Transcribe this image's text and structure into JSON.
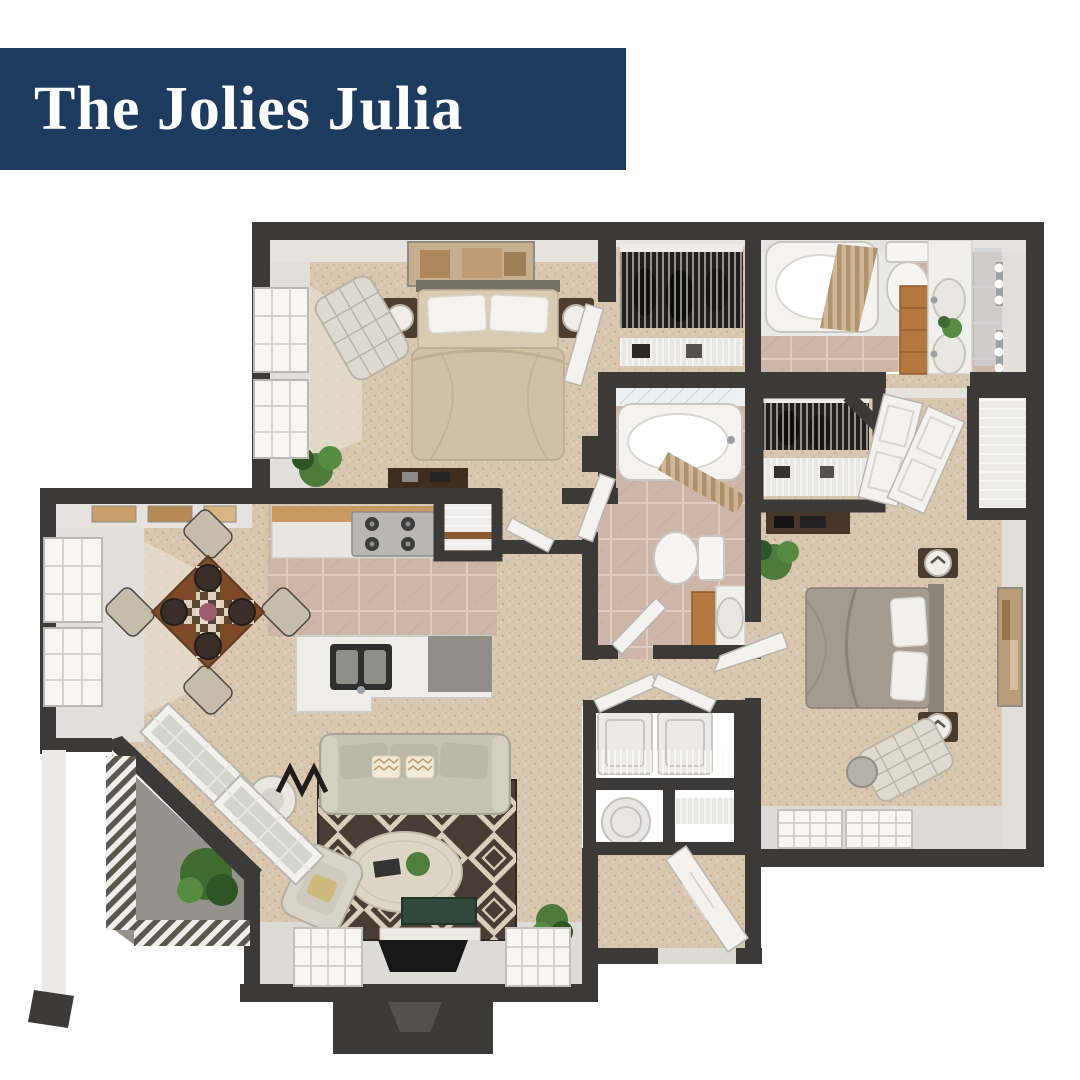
{
  "banner": {
    "title": "The Jolies Julia",
    "bg_color": "#1d3a5f",
    "text_color": "#ffffff"
  },
  "floor_plan": {
    "type": "3d-rendered-top-down-floor-plan",
    "palette": {
      "wall": "#3b3a38",
      "wall_face": "#e2dfda",
      "carpet": "#d8c6af",
      "tile": "#cdb5a7",
      "patio_concrete": "#95918b",
      "light_floor": "#dddbd6",
      "rug_dark": "#4a3d38",
      "rug_cream": "#d9cfba",
      "wood": "#7c4a28",
      "vanity_wood": "#b5793f",
      "plant_green": "#4e7a3c",
      "fixture_white": "#f4f2ef"
    },
    "rooms": [
      {
        "name": "bedroom-1",
        "features": [
          "bed-icon",
          "art-icon",
          "nightstand-lamp-icon",
          "chaise-icon",
          "plant-icon",
          "desk-icon",
          "windows"
        ]
      },
      {
        "name": "closet-1",
        "features": [
          "hanging-clothes-icon",
          "wire-shelf-icon"
        ]
      },
      {
        "name": "bathroom-2",
        "features": [
          "bathtub-icon",
          "shower-curtain-icon",
          "toilet-icon",
          "double-vanity-icon",
          "mirror-sconce-icon",
          "plant-icon"
        ]
      },
      {
        "name": "walk-in-closet",
        "features": [
          "hanging-clothes-icon",
          "wire-shelf-icon",
          "double-doors"
        ]
      },
      {
        "name": "linen-closet",
        "features": [
          "wire-shelf-icon"
        ]
      },
      {
        "name": "bathroom-1",
        "features": [
          "bathtub-icon",
          "shower-curtain-icon",
          "toilet-icon",
          "vanity-sink-icon",
          "door"
        ]
      },
      {
        "name": "dining-room",
        "features": [
          "dining-table-icon",
          "dining-chair-icon",
          "windows",
          "wall-art-icon"
        ]
      },
      {
        "name": "kitchen",
        "features": [
          "stove-icon",
          "counter-icon",
          "pantry-icon",
          "island-sink-icon",
          "tile-floor"
        ]
      },
      {
        "name": "living-room",
        "features": [
          "sofa-icon",
          "area-rug-icon",
          "coffee-table-icon",
          "armchair-icon",
          "floor-lamp-icon",
          "tv-console-icon",
          "tv-icon",
          "plant-icon",
          "windows"
        ]
      },
      {
        "name": "patio",
        "features": [
          "railing-icon",
          "plant-icon",
          "bay-windows"
        ]
      },
      {
        "name": "laundry-closet",
        "features": [
          "washer-icon",
          "dryer-icon",
          "wire-shelf-icon",
          "bifold-doors"
        ]
      },
      {
        "name": "utility-closet",
        "features": [
          "water-heater-icon",
          "wire-shelf-icon"
        ]
      },
      {
        "name": "bedroom-2",
        "features": [
          "bed-icon",
          "art-icon",
          "nightstand-lamp-icon",
          "chaise-icon",
          "dresser-icon",
          "plant-icon",
          "side-table-icon",
          "windows"
        ]
      },
      {
        "name": "entry",
        "features": [
          "front-door",
          "porch-vestibule"
        ]
      }
    ]
  }
}
